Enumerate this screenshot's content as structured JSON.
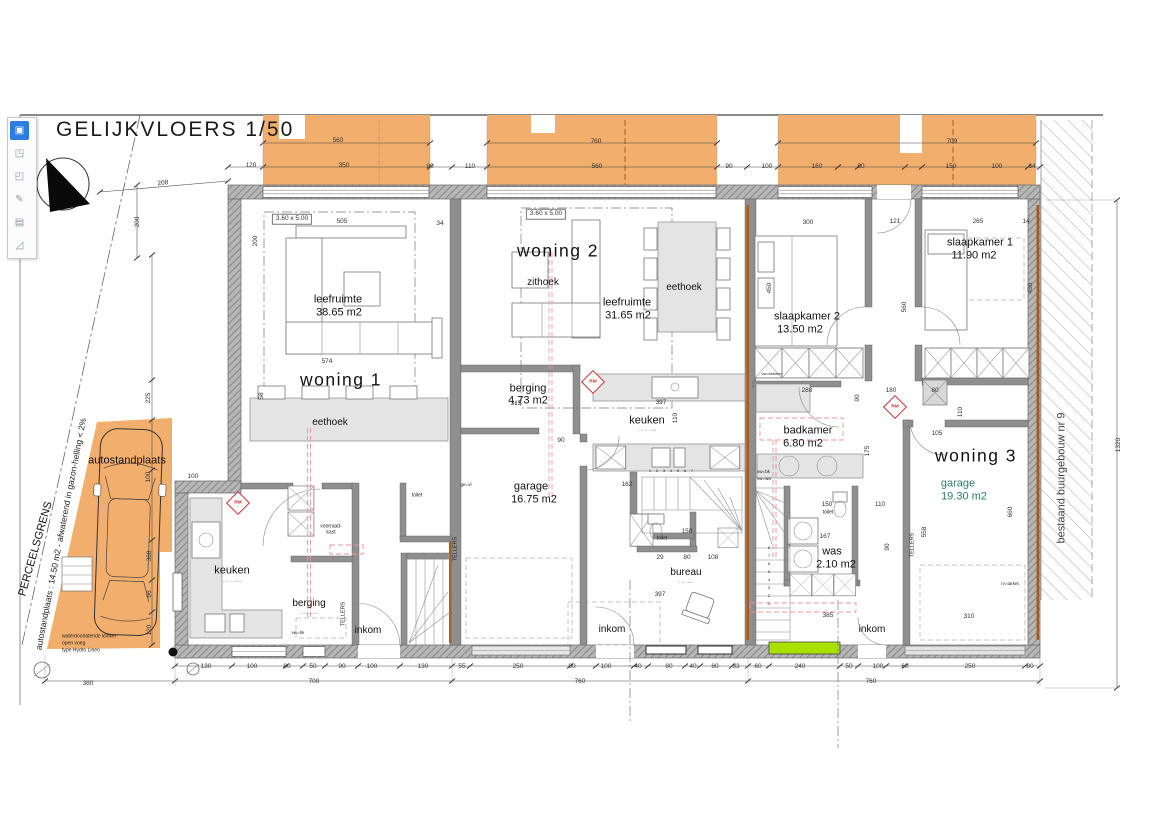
{
  "title": "GELIJKVLOERS  1/50",
  "colors": {
    "terrace_orange": "#F2AE6C",
    "green_door": "#A8E000",
    "wood_brown": "#A95A1C",
    "rm_red": "#D03030",
    "red_duct": "#EE9595",
    "wall_gray": "#8f8f8f",
    "toolbar_accent": "#2D7CE0"
  },
  "app": {
    "toolbar": {
      "icons": [
        {
          "name": "select-tool-icon",
          "glyph": "▣",
          "selected": true
        },
        {
          "name": "crop-tool-icon",
          "glyph": "◳",
          "selected": false
        },
        {
          "name": "expand-tool-icon",
          "glyph": "◰",
          "selected": false
        },
        {
          "name": "pen-tool-icon",
          "glyph": "✎",
          "selected": false
        },
        {
          "name": "notes-tool-icon",
          "glyph": "▤",
          "selected": false
        },
        {
          "name": "measure-tool-icon",
          "glyph": "◿",
          "selected": false
        }
      ]
    }
  },
  "plan": {
    "units": [
      {
        "id": "woning-1",
        "label": "woning  1",
        "rooms": [
          {
            "name": "leefruimte",
            "area": "38.65 m2"
          },
          {
            "name": "eethoek"
          },
          {
            "name": "keuken"
          },
          {
            "name": "berging"
          },
          {
            "name": "inkom"
          },
          {
            "name": "toilet"
          }
        ]
      },
      {
        "id": "woning-2",
        "label": "woning  2",
        "rooms": [
          {
            "name": "zithoek"
          },
          {
            "name": "leefruimte",
            "area": "31.65 m2"
          },
          {
            "name": "eethoek"
          },
          {
            "name": "berging",
            "area": "4.73 m2"
          },
          {
            "name": "keuken"
          },
          {
            "name": "garage",
            "area": "16.75 m2"
          },
          {
            "name": "toilet"
          },
          {
            "name": "bureau"
          },
          {
            "name": "inkom"
          }
        ]
      },
      {
        "id": "woning-3",
        "label": "woning  3",
        "rooms": [
          {
            "name": "slaapkamer 1",
            "area": "11.90 m2"
          },
          {
            "name": "slaapkamer 2",
            "area": "13.50 m2"
          },
          {
            "name": "badkamer",
            "area": "6.80 m2"
          },
          {
            "name": "was",
            "area": "2.10 m2"
          },
          {
            "name": "toilet"
          },
          {
            "name": "garage",
            "area": "19.30 m2"
          },
          {
            "name": "inkom"
          }
        ]
      }
    ],
    "rm_label": "RM",
    "rm_markers": [
      {
        "x": 238,
        "y": 503
      },
      {
        "x": 593,
        "y": 382
      },
      {
        "x": 895,
        "y": 407
      }
    ],
    "texts": [
      {
        "t": "autostandplaats",
        "x": 127,
        "y": 461,
        "c": "room"
      },
      {
        "t": "PERCEELSGRENS",
        "x": 36,
        "y": 549,
        "c": "room",
        "r": -74
      },
      {
        "t": "autostandplaats : 14.50 m2 - afwaterend in gazon-helling < 2%",
        "x": 61,
        "y": 534,
        "c": "note",
        "r": -79
      },
      {
        "t": "bestaand buurgebouw nr 9",
        "x": 1062,
        "y": 478,
        "c": "room",
        "r": -90,
        "col": "#444444"
      },
      {
        "t": "waterdoorlatende klinker",
        "x": 62,
        "y": 637,
        "c": "tiny left"
      },
      {
        "t": "open voeg",
        "x": 62,
        "y": 644,
        "c": "tiny left"
      },
      {
        "t": "type Hydro Lineo",
        "x": 62,
        "y": 651,
        "c": "tiny left"
      },
      {
        "t": "woning  1",
        "x": 341,
        "y": 380,
        "c": "big"
      },
      {
        "t": "leefruimte",
        "x": 338,
        "y": 300,
        "c": "room"
      },
      {
        "t": "38.65 m2",
        "x": 339,
        "y": 313,
        "c": "room"
      },
      {
        "t": "eethoek",
        "x": 330,
        "y": 423,
        "c": "room",
        "f": 10
      },
      {
        "t": "keuken",
        "x": 232,
        "y": 571,
        "c": "room"
      },
      {
        "t": ". .. .. .....",
        "x": 232,
        "y": 581,
        "c": "tiny"
      },
      {
        "t": "berging",
        "x": 309,
        "y": 604,
        "c": "room",
        "f": 10
      },
      {
        "t": ". ... .. ....",
        "x": 309,
        "y": 613,
        "c": "tiny"
      },
      {
        "t": "inkom",
        "x": 368,
        "y": 631,
        "c": "room",
        "f": 10
      },
      {
        "t": "toilet",
        "x": 417,
        "y": 496,
        "c": "tiny"
      },
      {
        "t": "voorraad-",
        "x": 331,
        "y": 527,
        "c": "tiny"
      },
      {
        "t": "kast",
        "x": 331,
        "y": 533,
        "c": "tiny"
      },
      {
        "t": "3.60  x  5.00",
        "x": 292,
        "y": 219,
        "c": "dim boxed"
      },
      {
        "t": "TELLERS",
        "x": 344,
        "y": 614,
        "c": "tiny",
        "f": 5.5,
        "r": -90
      },
      {
        "t": "woning  2",
        "x": 558,
        "y": 251,
        "c": "big"
      },
      {
        "t": "zithoek",
        "x": 543,
        "y": 283,
        "c": "room",
        "f": 10
      },
      {
        "t": "leefruimte",
        "x": 627,
        "y": 303,
        "c": "room"
      },
      {
        "t": "31.65 m2",
        "x": 628,
        "y": 316,
        "c": "room"
      },
      {
        "t": "eethoek",
        "x": 684,
        "y": 288,
        "c": "room",
        "f": 10
      },
      {
        "t": "berging",
        "x": 528,
        "y": 389,
        "c": "room"
      },
      {
        "t": "4.73 m2",
        "x": 528,
        "y": 401,
        "c": "room"
      },
      {
        "t": "keuken",
        "x": 647,
        "y": 421,
        "c": "room"
      },
      {
        "t": ". .. .. .....",
        "x": 647,
        "y": 430,
        "c": "tiny"
      },
      {
        "t": "garage",
        "x": 531,
        "y": 487,
        "c": "room"
      },
      {
        "t": "16.75 m2",
        "x": 534,
        "y": 500,
        "c": "room"
      },
      {
        "t": "toilet",
        "x": 662,
        "y": 539,
        "c": "tiny"
      },
      {
        "t": "bureau",
        "x": 686,
        "y": 573,
        "c": "room",
        "f": 10
      },
      {
        "t": ". .. .....",
        "x": 686,
        "y": 582,
        "c": "tiny"
      },
      {
        "t": "inkom",
        "x": 612,
        "y": 630,
        "c": "room",
        "f": 10
      },
      {
        "t": "3.60  x  5.00",
        "x": 546,
        "y": 214,
        "c": "dim boxed"
      },
      {
        "t": "TELLERS",
        "x": 456,
        "y": 549,
        "c": "tiny",
        "f": 5.5,
        "r": -90
      },
      {
        "t": "woning  3",
        "x": 976,
        "y": 456,
        "c": "big"
      },
      {
        "t": "slaapkamer  2",
        "x": 807,
        "y": 317,
        "c": "room"
      },
      {
        "t": "13.50 m2",
        "x": 800,
        "y": 330,
        "c": "room"
      },
      {
        "t": "slaapkamer  1",
        "x": 980,
        "y": 243,
        "c": "room"
      },
      {
        "t": "11.90 m2",
        "x": 974,
        "y": 256,
        "c": "room"
      },
      {
        "t": "badkamer",
        "x": 808,
        "y": 431,
        "c": "room"
      },
      {
        "t": "6.80 m2",
        "x": 803,
        "y": 444,
        "c": "room"
      },
      {
        "t": "was",
        "x": 832,
        "y": 552,
        "c": "room"
      },
      {
        "t": "2.10 m2",
        "x": 836,
        "y": 565,
        "c": "room"
      },
      {
        "t": "toilet",
        "x": 828,
        "y": 513,
        "c": "tiny"
      },
      {
        "t": "garage",
        "x": 958,
        "y": 484,
        "c": "room",
        "col": "#2e7f63"
      },
      {
        "t": "19.30 m2",
        "x": 964,
        "y": 497,
        "c": "room",
        "col": "#2e7f63"
      },
      {
        "t": "inkom",
        "x": 872,
        "y": 630,
        "c": "room",
        "f": 10
      },
      {
        "t": "TELLERS",
        "x": 913,
        "y": 545,
        "c": "tiny",
        "f": 5.5,
        "r": -90
      },
      {
        "t": "vw=bk",
        "x": 757,
        "y": 472,
        "c": "tiny left",
        "f": 4.5
      },
      {
        "t": "vw=wa",
        "x": 757,
        "y": 479,
        "c": "tiny left",
        "f": 4.5
      },
      {
        "t": "vw=bk",
        "x": 298,
        "y": 633,
        "c": "tiny",
        "f": 4.5
      },
      {
        "t": "ge=vl",
        "x": 466,
        "y": 485,
        "c": "tiny",
        "f": 4.5
      },
      {
        "t": "rv=tarket",
        "x": 1010,
        "y": 584,
        "c": "tiny",
        "f": 4.5
      },
      {
        "t": "vw=bekleed",
        "x": 772,
        "y": 374,
        "c": "tiny",
        "f": 4
      },
      {
        "t": "560",
        "x": 338,
        "y": 141
      },
      {
        "t": "760",
        "x": 596,
        "y": 142
      },
      {
        "t": "709",
        "x": 952,
        "y": 142
      },
      {
        "t": "120",
        "x": 251,
        "y": 166
      },
      {
        "t": "350",
        "x": 344,
        "y": 166
      },
      {
        "t": "90",
        "x": 430,
        "y": 167
      },
      {
        "t": "110",
        "x": 470,
        "y": 167
      },
      {
        "t": "560",
        "x": 597,
        "y": 167
      },
      {
        "t": "90",
        "x": 729,
        "y": 167
      },
      {
        "t": "100",
        "x": 767,
        "y": 167
      },
      {
        "t": "160",
        "x": 817,
        "y": 167
      },
      {
        "t": "80",
        "x": 861,
        "y": 167
      },
      {
        "t": "150",
        "x": 951,
        "y": 167
      },
      {
        "t": "100",
        "x": 997,
        "y": 167
      },
      {
        "t": "64",
        "x": 1032,
        "y": 167
      },
      {
        "t": "505",
        "x": 342,
        "y": 222
      },
      {
        "t": "34",
        "x": 440,
        "y": 224
      },
      {
        "t": "300",
        "x": 808,
        "y": 223
      },
      {
        "t": "121",
        "x": 895,
        "y": 222
      },
      {
        "t": "265",
        "x": 978,
        "y": 222
      },
      {
        "t": "14",
        "x": 1026,
        "y": 222
      },
      {
        "t": "200",
        "x": 256,
        "y": 241,
        "r": -90
      },
      {
        "t": "200",
        "x": 138,
        "y": 222,
        "r": -90
      },
      {
        "t": "208",
        "x": 163,
        "y": 184,
        "r": -6
      },
      {
        "t": "574",
        "x": 327,
        "y": 362
      },
      {
        "t": "58",
        "x": 262,
        "y": 396,
        "r": -90
      },
      {
        "t": "225",
        "x": 149,
        "y": 398,
        "r": -90
      },
      {
        "t": "100",
        "x": 149,
        "y": 477,
        "r": -90
      },
      {
        "t": "368",
        "x": 150,
        "y": 556,
        "r": -90
      },
      {
        "t": "96",
        "x": 150,
        "y": 594,
        "r": -90
      },
      {
        "t": "120",
        "x": 150,
        "y": 630,
        "r": -90
      },
      {
        "t": "100",
        "x": 193,
        "y": 477
      },
      {
        "t": "450",
        "x": 770,
        "y": 288,
        "r": -90
      },
      {
        "t": "450",
        "x": 1031,
        "y": 288,
        "r": -90
      },
      {
        "t": "560",
        "x": 905,
        "y": 307,
        "r": -90
      },
      {
        "t": "315",
        "x": 516,
        "y": 404
      },
      {
        "t": "397",
        "x": 661,
        "y": 403
      },
      {
        "t": "110",
        "x": 676,
        "y": 418,
        "r": -90
      },
      {
        "t": "90",
        "x": 561,
        "y": 441
      },
      {
        "t": "162",
        "x": 627,
        "y": 485
      },
      {
        "t": "150",
        "x": 687,
        "y": 532
      },
      {
        "t": "29",
        "x": 660,
        "y": 558
      },
      {
        "t": "80",
        "x": 687,
        "y": 558
      },
      {
        "t": "108",
        "x": 713,
        "y": 558
      },
      {
        "t": "397",
        "x": 660,
        "y": 595
      },
      {
        "t": "288",
        "x": 807,
        "y": 391
      },
      {
        "t": "180",
        "x": 891,
        "y": 391
      },
      {
        "t": "80",
        "x": 935,
        "y": 391
      },
      {
        "t": "90",
        "x": 858,
        "y": 398,
        "r": -90
      },
      {
        "t": "175",
        "x": 868,
        "y": 451,
        "r": -90
      },
      {
        "t": "110",
        "x": 961,
        "y": 412,
        "r": -90
      },
      {
        "t": "105",
        "x": 937,
        "y": 434
      },
      {
        "t": "150",
        "x": 827,
        "y": 505
      },
      {
        "t": "110",
        "x": 880,
        "y": 505
      },
      {
        "t": "167",
        "x": 825,
        "y": 537
      },
      {
        "t": "90",
        "x": 888,
        "y": 547,
        "r": -90
      },
      {
        "t": "385",
        "x": 828,
        "y": 616
      },
      {
        "t": "310",
        "x": 969,
        "y": 617
      },
      {
        "t": "558",
        "x": 925,
        "y": 532,
        "r": -90
      },
      {
        "t": "660",
        "x": 1011,
        "y": 512,
        "r": -90
      },
      {
        "t": "1320",
        "x": 1119,
        "y": 445,
        "r": -90
      },
      {
        "t": "130",
        "x": 206,
        "y": 667
      },
      {
        "t": "100",
        "x": 252,
        "y": 667
      },
      {
        "t": "80",
        "x": 287,
        "y": 667
      },
      {
        "t": "50",
        "x": 313,
        "y": 667
      },
      {
        "t": "90",
        "x": 342,
        "y": 667
      },
      {
        "t": "100",
        "x": 372,
        "y": 667
      },
      {
        "t": "130",
        "x": 423,
        "y": 667
      },
      {
        "t": "55",
        "x": 462,
        "y": 667
      },
      {
        "t": "250",
        "x": 518,
        "y": 667
      },
      {
        "t": "80",
        "x": 572,
        "y": 667
      },
      {
        "t": "100",
        "x": 606,
        "y": 667
      },
      {
        "t": "40",
        "x": 638,
        "y": 667
      },
      {
        "t": "80",
        "x": 669,
        "y": 667
      },
      {
        "t": "40",
        "x": 693,
        "y": 667
      },
      {
        "t": "80",
        "x": 715,
        "y": 667
      },
      {
        "t": "33",
        "x": 736,
        "y": 667
      },
      {
        "t": "60",
        "x": 758,
        "y": 667
      },
      {
        "t": "240",
        "x": 800,
        "y": 667
      },
      {
        "t": "50",
        "x": 849,
        "y": 667
      },
      {
        "t": "100",
        "x": 878,
        "y": 667
      },
      {
        "t": "60",
        "x": 905,
        "y": 667
      },
      {
        "t": "250",
        "x": 970,
        "y": 667
      },
      {
        "t": "80",
        "x": 1030,
        "y": 667
      },
      {
        "t": "700",
        "x": 314,
        "y": 682
      },
      {
        "t": "760",
        "x": 580,
        "y": 682
      },
      {
        "t": "760",
        "x": 871,
        "y": 682
      },
      {
        "t": "380",
        "x": 88,
        "y": 684
      },
      {
        "t": "1",
        "x": 650,
        "y": 471,
        "c": "tiny",
        "f": 4
      },
      {
        "t": "2",
        "x": 657,
        "y": 471,
        "c": "tiny",
        "f": 4
      },
      {
        "t": "3",
        "x": 664,
        "y": 471,
        "c": "tiny",
        "f": 4
      },
      {
        "t": "4",
        "x": 671,
        "y": 471,
        "c": "tiny",
        "f": 4
      },
      {
        "t": "5",
        "x": 678,
        "y": 471,
        "c": "tiny",
        "f": 4
      },
      {
        "t": "6",
        "x": 685,
        "y": 471,
        "c": "tiny",
        "f": 4
      },
      {
        "t": "7",
        "x": 692,
        "y": 471,
        "c": "tiny",
        "f": 4
      },
      {
        "t": "8",
        "x": 769,
        "y": 548,
        "c": "tiny",
        "f": 4
      },
      {
        "t": "7",
        "x": 769,
        "y": 556,
        "c": "tiny",
        "f": 4
      },
      {
        "t": "6",
        "x": 769,
        "y": 564,
        "c": "tiny",
        "f": 4
      },
      {
        "t": "5",
        "x": 769,
        "y": 572,
        "c": "tiny",
        "f": 4
      },
      {
        "t": "4",
        "x": 769,
        "y": 580,
        "c": "tiny",
        "f": 4
      },
      {
        "t": "3",
        "x": 769,
        "y": 588,
        "c": "tiny",
        "f": 4
      },
      {
        "t": "2",
        "x": 769,
        "y": 596,
        "c": "tiny",
        "f": 4
      },
      {
        "t": "1",
        "x": 769,
        "y": 604,
        "c": "tiny",
        "f": 4
      }
    ]
  }
}
